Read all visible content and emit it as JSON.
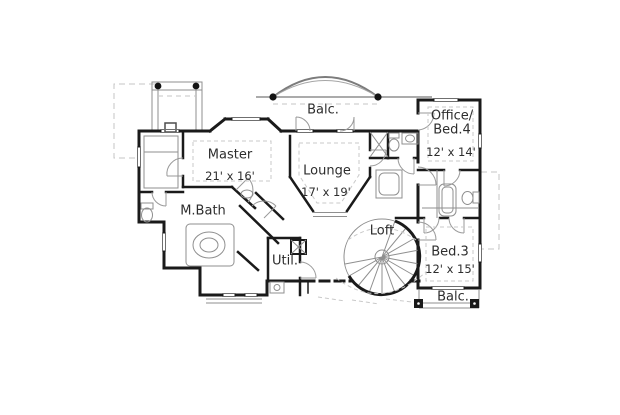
{
  "figure": {
    "type": "floor-plan",
    "background": "#ffffff"
  },
  "colors": {
    "wall": "#1a1a1a",
    "thin_line": "#8f8f8f",
    "light_dash": "#c6c6c6",
    "text": "#2d2d2d"
  },
  "rooms": {
    "balc_top": {
      "label": "Balc."
    },
    "master": {
      "label": "Master",
      "dims": "21' x 16'"
    },
    "lounge": {
      "label": "Lounge",
      "dims": "17' x 19'"
    },
    "office_bed4": {
      "label_line1": "Office/",
      "label_line2": "Bed.4",
      "dims": "12' x 14'"
    },
    "mbath": {
      "label": "M.Bath"
    },
    "util": {
      "label": "Util."
    },
    "loft": {
      "label": "Loft"
    },
    "bed3": {
      "label": "Bed.3",
      "dims": "12' x 15'"
    },
    "balc_bottom": {
      "label": "Balc."
    }
  }
}
